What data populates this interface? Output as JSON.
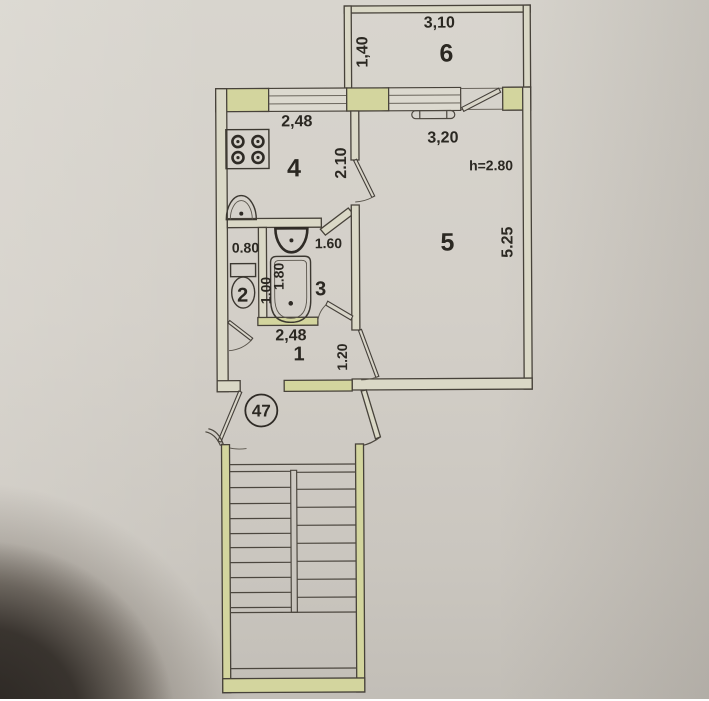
{
  "plan": {
    "type": "apartment-floor-plan",
    "apartment_number": "47",
    "ceiling_height_label": "h=2.80",
    "balcony": {
      "number": "6",
      "width_label": "3,10",
      "depth_label": "1,40"
    },
    "kitchen": {
      "number": "4",
      "width_label": "2,48",
      "depth_label": "2.10"
    },
    "living_room": {
      "number": "5",
      "width_label": "3,20",
      "length_label": "5.25"
    },
    "bathroom": {
      "number": "3",
      "width_label": "1.60",
      "tub_label": "1.80"
    },
    "wc": {
      "number": "2",
      "width_label": "0.80",
      "depth_label": "1.00"
    },
    "hallway": {
      "number": "1",
      "width_label": "2,48",
      "depth_label": "1.20"
    }
  },
  "colors": {
    "paper": "#d3cfc8",
    "line": "#47423a",
    "wall_fill": "#dad8c6",
    "pier_fill": "#d3d59e",
    "text": "#2b2822",
    "corner_shadow": "#2a241e"
  }
}
